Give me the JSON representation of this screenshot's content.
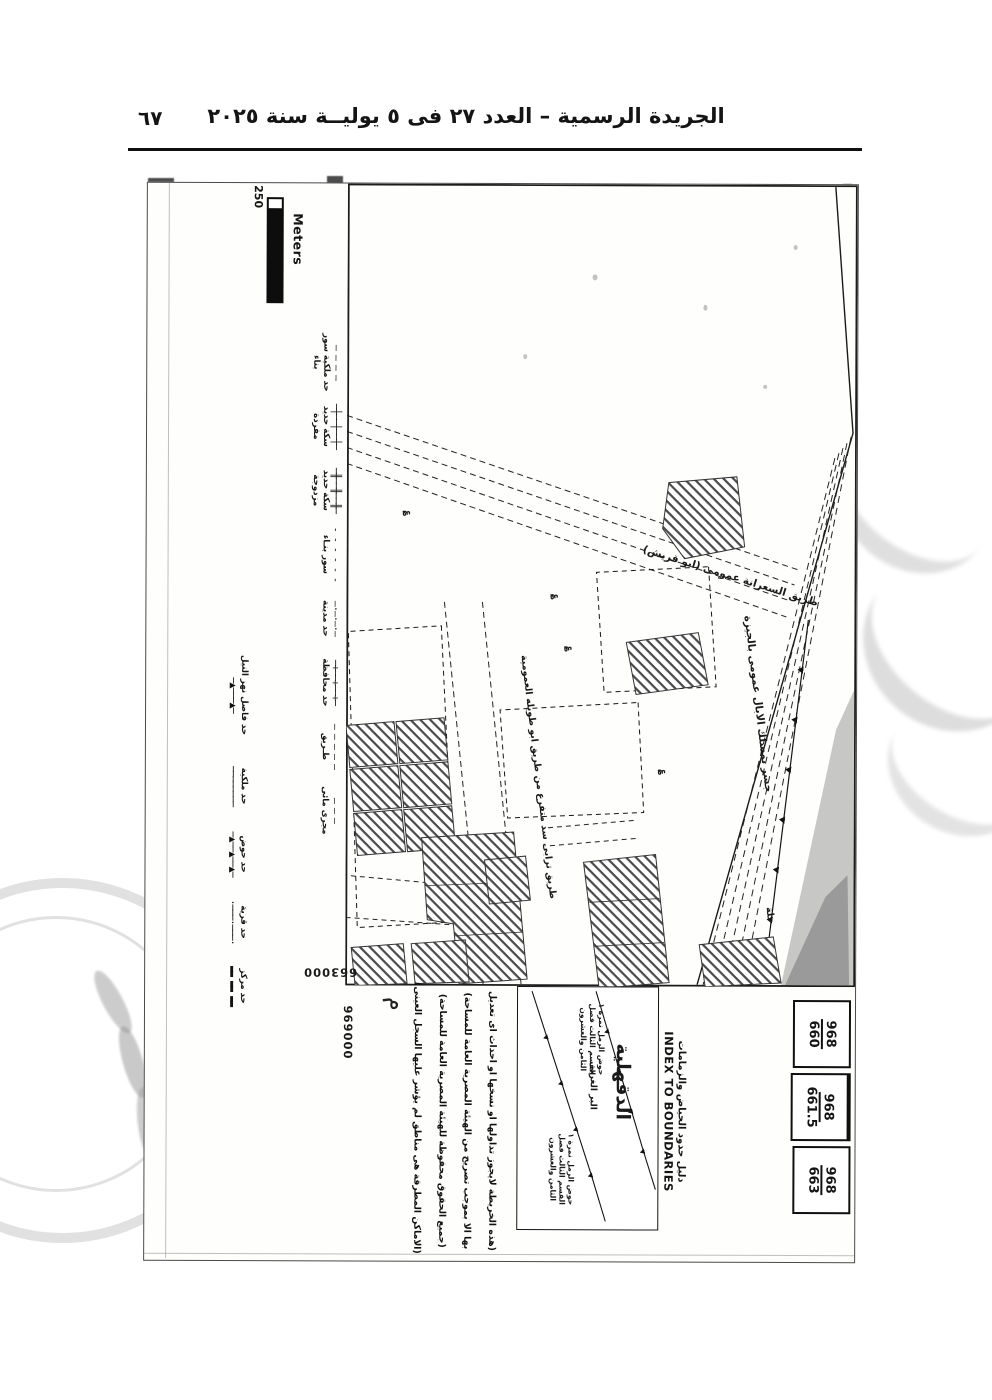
{
  "page": {
    "header_title": "الجريدة الرسمية – العدد ٢٧ فى ٥ يوليــة سنة ٢٠٢٥",
    "page_number": "٦٧"
  },
  "scale_bar": {
    "value": "250",
    "unit": "Meters"
  },
  "legend": {
    "row1": [
      {
        "label": "حد ملكية سور بناء",
        "glyph": "— — — —"
      },
      {
        "label": "سكة حديد مفردة",
        "glyph": "─┼──┼──┼─"
      },
      {
        "label": "سكة حديد مزدوجة",
        "glyph": "─╫──╫──╫─"
      },
      {
        "label": "سور بنـاء",
        "glyph": "- - - - - -"
      },
      {
        "label": "حد مدينة",
        "glyph": "—·—·—·—"
      },
      {
        "label": "حد محافظة",
        "glyph": "─+──+──+─"
      },
      {
        "label": "طـريق",
        "glyph": "– – – – –"
      },
      {
        "label": "مجرى مائى",
        "glyph": "—  —  —"
      }
    ],
    "row2": [
      {
        "label": "حد فاصل نهر النيل",
        "glyph": "─▲───▲─"
      },
      {
        "label": "حد ملكية",
        "glyph": "────────"
      },
      {
        "label": "حد حوض",
        "glyph": "─▲──▲──▲─"
      },
      {
        "label": "حد قرية",
        "glyph": "·───·───·"
      },
      {
        "label": "حد مركز",
        "glyph": "▬▬ ▬▬ ▬▬"
      }
    ]
  },
  "map": {
    "road1": "طريق السعرانة عمومى (ابو قريش)",
    "bridge": "جسر بمسلك الابال عمومى بالجيزة",
    "road3": "طريق ترابى سد متفرع من طريق ابو طويله العمومية",
    "hamlet": "حلة",
    "easting": "663000",
    "northing": "969000",
    "hand_mark": "م",
    "survey_mark_glyph": "؏"
  },
  "index_panel": {
    "title_ar": "دليل حدود الحياض والزمامات",
    "title_en": "INDEX TO BOUNDARIES",
    "governorate": "الدقهلية",
    "bank": "البر الغربى",
    "note_lines": [
      "حوض الرمل نمرة ١",
      "القسم الثالث فصل",
      "الثامن والعشرون"
    ]
  },
  "sheet_index": [
    {
      "top": "968",
      "bottom": "660"
    },
    {
      "top": "968",
      "bottom": "661.5"
    },
    {
      "top": "968",
      "bottom": "663"
    }
  ],
  "disclaimer": [
    "(هذه الخريطة لايجوز تداولها او نسخها او احداث اى تعديل",
    "بها الا بموجب تصريح من الهيئة المصرية العامة للمساحة)",
    "(جميع الحقوق محفوظة للهيئة المصرية العامة للمساحة)",
    "(الاماكن المطرقة هى مناطق لم يؤشر عليها السجل العينى)"
  ]
}
